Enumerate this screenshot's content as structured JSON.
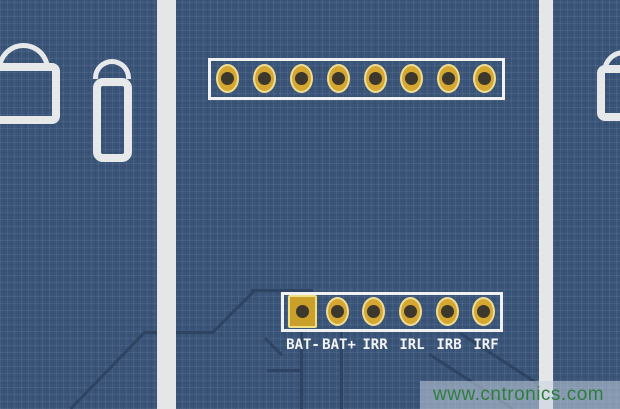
{
  "connectors": {
    "top": {
      "type": "header",
      "pin_count": 8
    },
    "bottom": {
      "type": "header",
      "pin_count": 6,
      "pin_labels": [
        "BAT-",
        "BAT+",
        "IRR",
        "IRL",
        "IRB",
        "IRF"
      ]
    }
  },
  "watermark": {
    "text": "www.cntronics.com"
  },
  "colors": {
    "board": "#3a5579",
    "silkscreen": "#e7e8ea",
    "panel_strip": "#e5e6e8",
    "pad_gold": "#d5a731",
    "pad_rim": "#eedd96",
    "square_pad_gold": "#cba02a",
    "drill_hole": "#3c382e",
    "copper_trace": "#2e4462",
    "label_text": "#f3f3f3",
    "watermark_text": "#2f7e3e",
    "watermark_band": "rgba(199,210,222,0.55)"
  }
}
